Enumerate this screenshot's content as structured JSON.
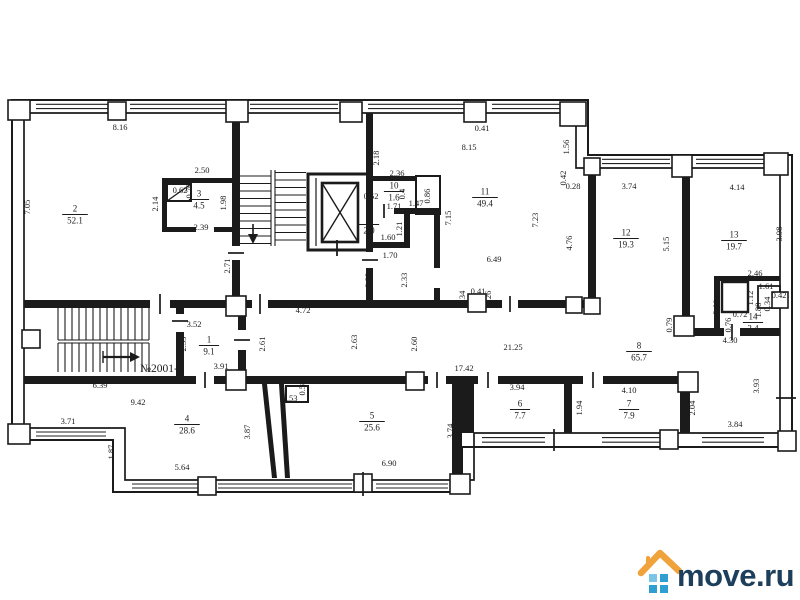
{
  "watermark": {
    "text": "move.ru",
    "roof_color": "#f0a23b",
    "square_color": "#2f9fd2",
    "square_light": "#7ac4e8",
    "text_color": "#1d3f5c"
  },
  "plan": {
    "unit_label": "№2001-2",
    "line_color": "#1b1b1b",
    "rooms": [
      {
        "num": "1",
        "area": "9.1",
        "x": 209,
        "y": 345
      },
      {
        "num": "2",
        "area": "52.1",
        "x": 75,
        "y": 214
      },
      {
        "num": "3",
        "area": "4.5",
        "x": 199,
        "y": 199
      },
      {
        "num": "4",
        "area": "28.6",
        "x": 187,
        "y": 424
      },
      {
        "num": "5",
        "area": "25.6",
        "x": 372,
        "y": 421
      },
      {
        "num": "6",
        "area": "7.7",
        "x": 520,
        "y": 409
      },
      {
        "num": "7",
        "area": "7.9",
        "x": 629,
        "y": 409
      },
      {
        "num": "8",
        "area": "65.7",
        "x": 639,
        "y": 351
      },
      {
        "num": "9",
        "area": "2.0",
        "x": 369,
        "y": 224
      },
      {
        "num": "10",
        "area": "1.6",
        "x": 394,
        "y": 191
      },
      {
        "num": "11",
        "area": "49.4",
        "x": 485,
        "y": 197
      },
      {
        "num": "12",
        "area": "19.3",
        "x": 626,
        "y": 238
      },
      {
        "num": "13",
        "area": "19.7",
        "x": 734,
        "y": 240
      },
      {
        "num": "14",
        "area": "3.4",
        "x": 753,
        "y": 322
      }
    ],
    "dims": [
      {
        "t": "8.16",
        "x": 120,
        "y": 130
      },
      {
        "t": "7.05",
        "x": 30,
        "y": 207,
        "r": 1
      },
      {
        "t": "2.50",
        "x": 202,
        "y": 173
      },
      {
        "t": "0.62",
        "x": 180,
        "y": 193
      },
      {
        "t": "0.70",
        "x": 192,
        "y": 191,
        "r": 1
      },
      {
        "t": "2.14",
        "x": 158,
        "y": 204,
        "r": 1
      },
      {
        "t": "1.98",
        "x": 226,
        "y": 203,
        "r": 1
      },
      {
        "t": "2.39",
        "x": 201,
        "y": 230
      },
      {
        "t": "2.71",
        "x": 230,
        "y": 266,
        "r": 1
      },
      {
        "t": "2.18",
        "x": 379,
        "y": 158,
        "r": 1
      },
      {
        "t": "2.36",
        "x": 397,
        "y": 176
      },
      {
        "t": "0.52",
        "x": 371,
        "y": 199
      },
      {
        "t": "1.71",
        "x": 394,
        "y": 209
      },
      {
        "t": "1.47",
        "x": 416,
        "y": 206
      },
      {
        "t": "0.86",
        "x": 430,
        "y": 196,
        "r": 1
      },
      {
        "t": "0.4",
        "x": 405,
        "y": 194,
        "r": 1
      },
      {
        "t": "1.21",
        "x": 402,
        "y": 229,
        "r": 1
      },
      {
        "t": "1.60",
        "x": 388,
        "y": 240
      },
      {
        "t": "1.70",
        "x": 390,
        "y": 258
      },
      {
        "t": "2.32",
        "x": 371,
        "y": 280,
        "r": 1
      },
      {
        "t": "2.33",
        "x": 407,
        "y": 280,
        "r": 1
      },
      {
        "t": "0.41",
        "x": 482,
        "y": 131
      },
      {
        "t": "8.15",
        "x": 469,
        "y": 150
      },
      {
        "t": "1.56",
        "x": 569,
        "y": 147,
        "r": 1
      },
      {
        "t": "0.42",
        "x": 566,
        "y": 178,
        "r": 1
      },
      {
        "t": "0.28",
        "x": 573,
        "y": 189
      },
      {
        "t": "7.15",
        "x": 451,
        "y": 218,
        "r": 1
      },
      {
        "t": "7.23",
        "x": 538,
        "y": 220,
        "r": 1
      },
      {
        "t": "4.76",
        "x": 572,
        "y": 243,
        "r": 1
      },
      {
        "t": "6.49",
        "x": 494,
        "y": 262
      },
      {
        "t": "0.34",
        "x": 465,
        "y": 298,
        "r": 1
      },
      {
        "t": "0.41",
        "x": 478,
        "y": 294
      },
      {
        "t": "0.26",
        "x": 491,
        "y": 298,
        "r": 1
      },
      {
        "t": "3.74",
        "x": 629,
        "y": 189
      },
      {
        "t": "4.14",
        "x": 737,
        "y": 190
      },
      {
        "t": "5.15",
        "x": 669,
        "y": 244,
        "r": 1
      },
      {
        "t": "3.98",
        "x": 782,
        "y": 234,
        "r": 1
      },
      {
        "t": "2.46",
        "x": 755,
        "y": 276
      },
      {
        "t": "1.61",
        "x": 766,
        "y": 289
      },
      {
        "t": "1.12",
        "x": 753,
        "y": 298,
        "r": 1
      },
      {
        "t": "2.00",
        "x": 719,
        "y": 307,
        "r": 1
      },
      {
        "t": "0.72",
        "x": 740,
        "y": 317
      },
      {
        "t": "0.76",
        "x": 731,
        "y": 325,
        "r": 1
      },
      {
        "t": "1.88",
        "x": 761,
        "y": 310,
        "r": 1
      },
      {
        "t": "0.34",
        "x": 770,
        "y": 304,
        "r": 1
      },
      {
        "t": "0.42",
        "x": 779,
        "y": 298
      },
      {
        "t": "0.79",
        "x": 672,
        "y": 325,
        "r": 1
      },
      {
        "t": "4.30",
        "x": 730,
        "y": 343
      },
      {
        "t": "3.93",
        "x": 759,
        "y": 386,
        "r": 1
      },
      {
        "t": "3.52",
        "x": 194,
        "y": 327
      },
      {
        "t": "2.53",
        "x": 186,
        "y": 344,
        "r": 1
      },
      {
        "t": "3.91",
        "x": 221,
        "y": 369
      },
      {
        "t": "4.72",
        "x": 303,
        "y": 313
      },
      {
        "t": "2.61",
        "x": 265,
        "y": 344,
        "r": 1
      },
      {
        "t": "2.63",
        "x": 357,
        "y": 342,
        "r": 1
      },
      {
        "t": "2.60",
        "x": 417,
        "y": 344,
        "r": 1
      },
      {
        "t": "21.25",
        "x": 513,
        "y": 350
      },
      {
        "t": "17.42",
        "x": 464,
        "y": 371
      },
      {
        "t": "6.39",
        "x": 100,
        "y": 388
      },
      {
        "t": "9.42",
        "x": 138,
        "y": 405
      },
      {
        "t": "3.71",
        "x": 68,
        "y": 424
      },
      {
        "t": "1.87",
        "x": 114,
        "y": 452,
        "r": 1
      },
      {
        "t": "5.64",
        "x": 182,
        "y": 470
      },
      {
        "t": "0.53",
        "x": 290,
        "y": 401
      },
      {
        "t": "0.58",
        "x": 305,
        "y": 388,
        "r": 1
      },
      {
        "t": "3.87",
        "x": 250,
        "y": 432,
        "r": 1
      },
      {
        "t": "6.90",
        "x": 389,
        "y": 466
      },
      {
        "t": "3.74",
        "x": 453,
        "y": 431,
        "r": 1
      },
      {
        "t": "1.96",
        "x": 470,
        "y": 406,
        "r": 1
      },
      {
        "t": "3.94",
        "x": 517,
        "y": 390
      },
      {
        "t": "1.94",
        "x": 582,
        "y": 408,
        "r": 1
      },
      {
        "t": "4.10",
        "x": 629,
        "y": 393
      },
      {
        "t": "2.04",
        "x": 695,
        "y": 408,
        "r": 1
      },
      {
        "t": "3.84",
        "x": 735,
        "y": 427
      }
    ]
  }
}
